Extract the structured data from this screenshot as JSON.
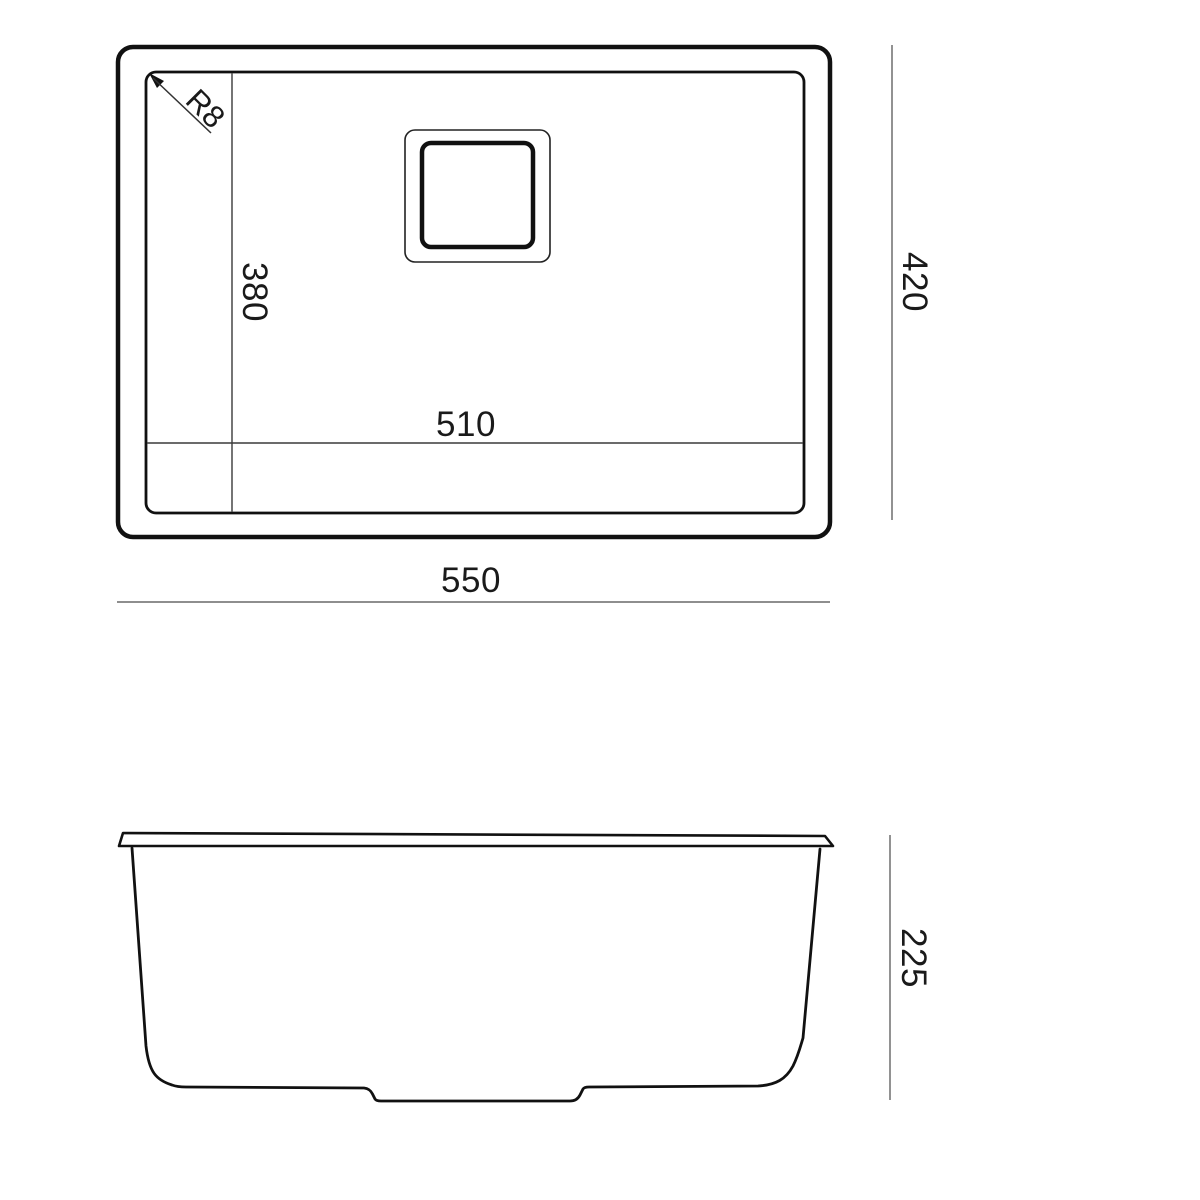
{
  "drawing": {
    "type": "technical-dimension-drawing",
    "views": {
      "top_view": {
        "corner_radius_label": "R8",
        "inner_height_label": "380",
        "inner_width_label": "510",
        "overall_height_label": "420",
        "overall_width_label": "550"
      },
      "side_view": {
        "depth_label": "225"
      }
    },
    "colors": {
      "outline": "#111111",
      "dimension_line": "#4a4a4a",
      "text": "#1a1a1a",
      "background": "#ffffff"
    }
  }
}
